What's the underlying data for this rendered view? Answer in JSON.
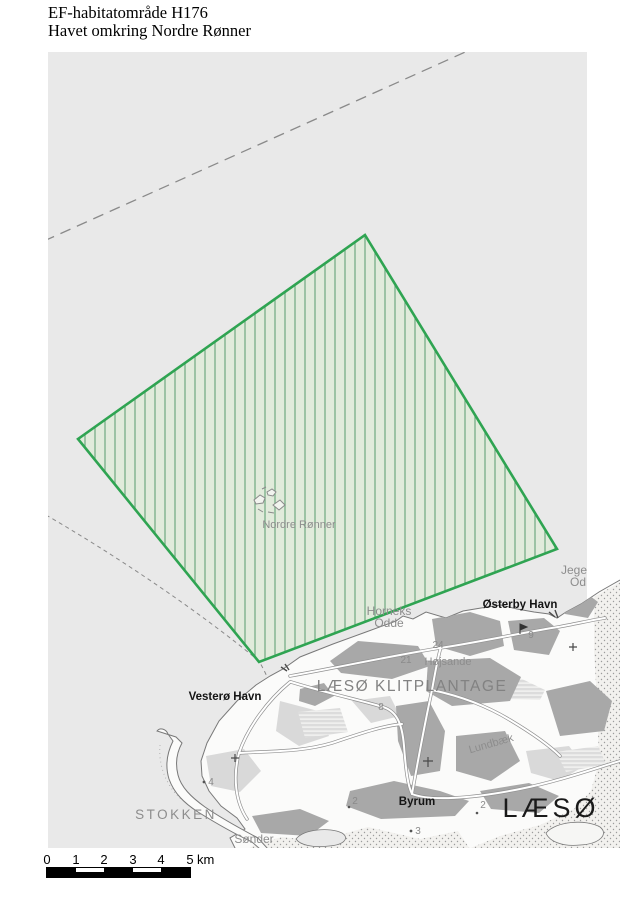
{
  "title": {
    "line1": "EF-habitatområde H176",
    "line2": "Havet omkring Nordre Rønner"
  },
  "map": {
    "labels": {
      "nordre_ronner": "Nordre Rønner",
      "vestero_havn": "Vesterø Havn",
      "osterby_havn": "Østerby Havn",
      "klitplantage": "LÆSØ KLITPLANTAGE",
      "byrum": "Byrum",
      "laeso": "LÆSØ",
      "lundbaek": "Lundbæk",
      "horneks_line1": "Horneks",
      "horneks_line2": "Odde",
      "hojsande": "Højsande",
      "stokken": "STOKKEN",
      "sonder": "Sønder",
      "jege_line1": "Jege",
      "jege_line2": "Od",
      "road8": "8",
      "road9": "9",
      "n24": "24",
      "n21": "21",
      "n2": "2",
      "n2b": "2",
      "n3": "3",
      "n4": "4"
    }
  },
  "scalebar": {
    "ticks": [
      "0",
      "1",
      "2",
      "3",
      "4",
      "5"
    ],
    "unit": "km"
  },
  "colors": {
    "sea": "#e9e9e9",
    "habitat_fill": "#e1ebdb",
    "habitat_hatch": "#76ae87",
    "habitat_border": "#2fa452",
    "boundary_dash": "#8a8a8a",
    "land": "#fbfbfa",
    "coast": "#787878",
    "forest": "#a8a8a8",
    "patch_light": "#d9d9d9",
    "stipple_bg": "#f2f1ee",
    "stipple_dot": "#9c9c9c",
    "label_gray": "#8d8d8d",
    "label_dark": "#141414",
    "road_casing": "#909090",
    "road_fill": "#ffffff",
    "scalebar_black": "#000000"
  }
}
